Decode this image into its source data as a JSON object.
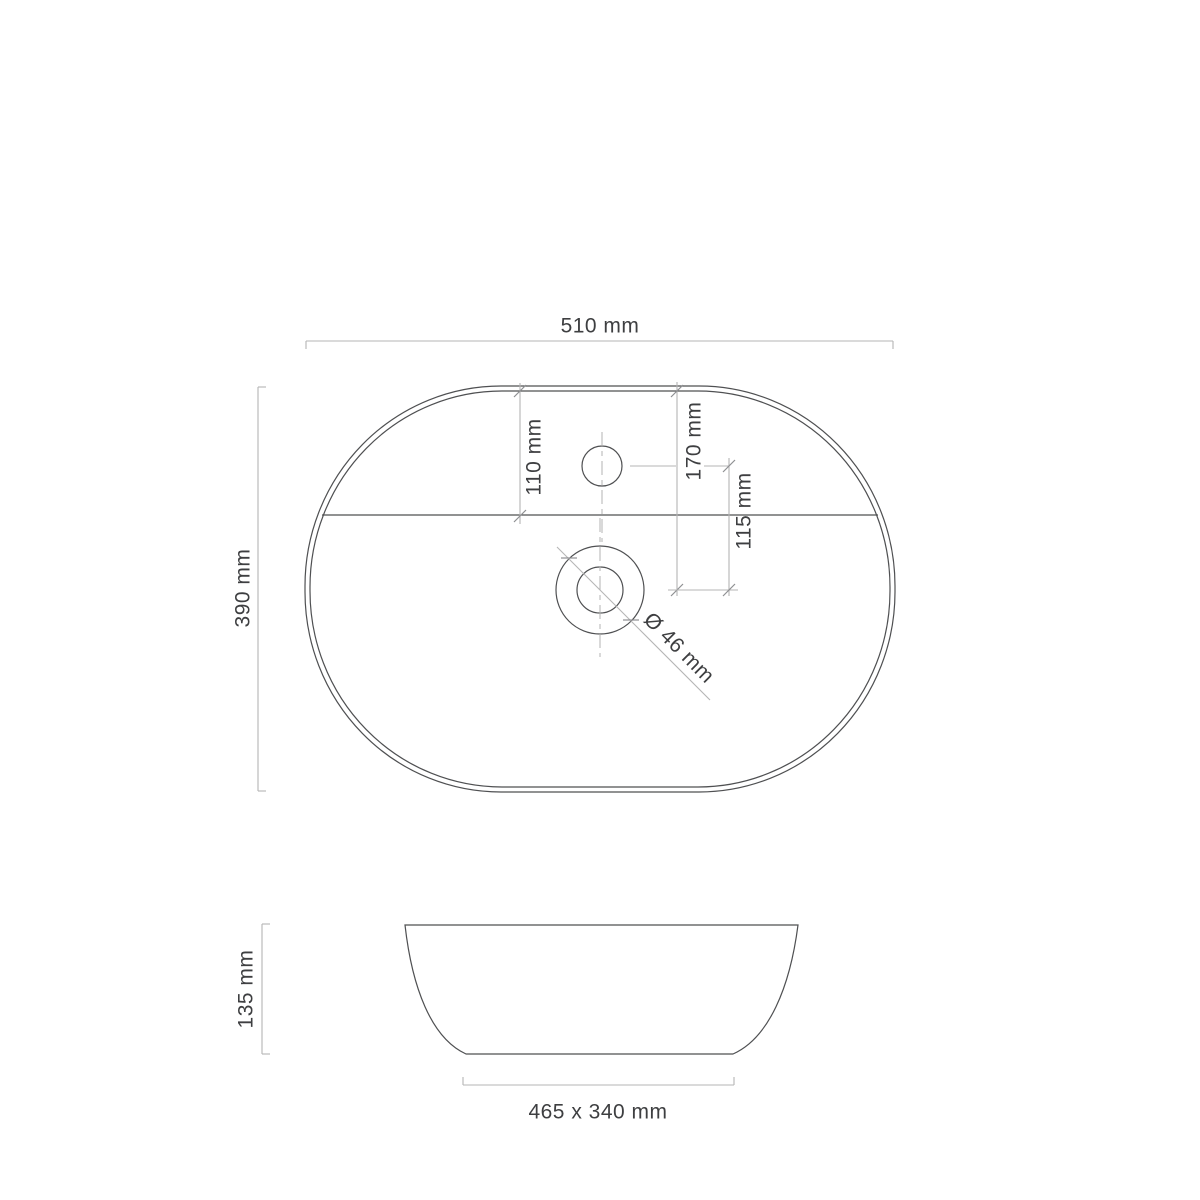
{
  "drawing": {
    "title": "washbasin-dimension-drawing",
    "colors": {
      "background": "#ffffff",
      "object_line": "#4f5052",
      "dimension_line": "#b5b5b5",
      "tick_mark": "#8f9092",
      "centerline": "#b3b3b3",
      "label_text": "#3e3f41"
    },
    "top_view": {
      "overall_width": "510 mm",
      "overall_depth": "390 mm",
      "rim_to_ledge": "110 mm",
      "rim_to_drain_center": "170 mm",
      "faucet_to_drain": "115 mm",
      "drain_diameter": "Ø 46 mm"
    },
    "side_view": {
      "height": "135 mm",
      "base": "465 x 340 mm"
    }
  }
}
